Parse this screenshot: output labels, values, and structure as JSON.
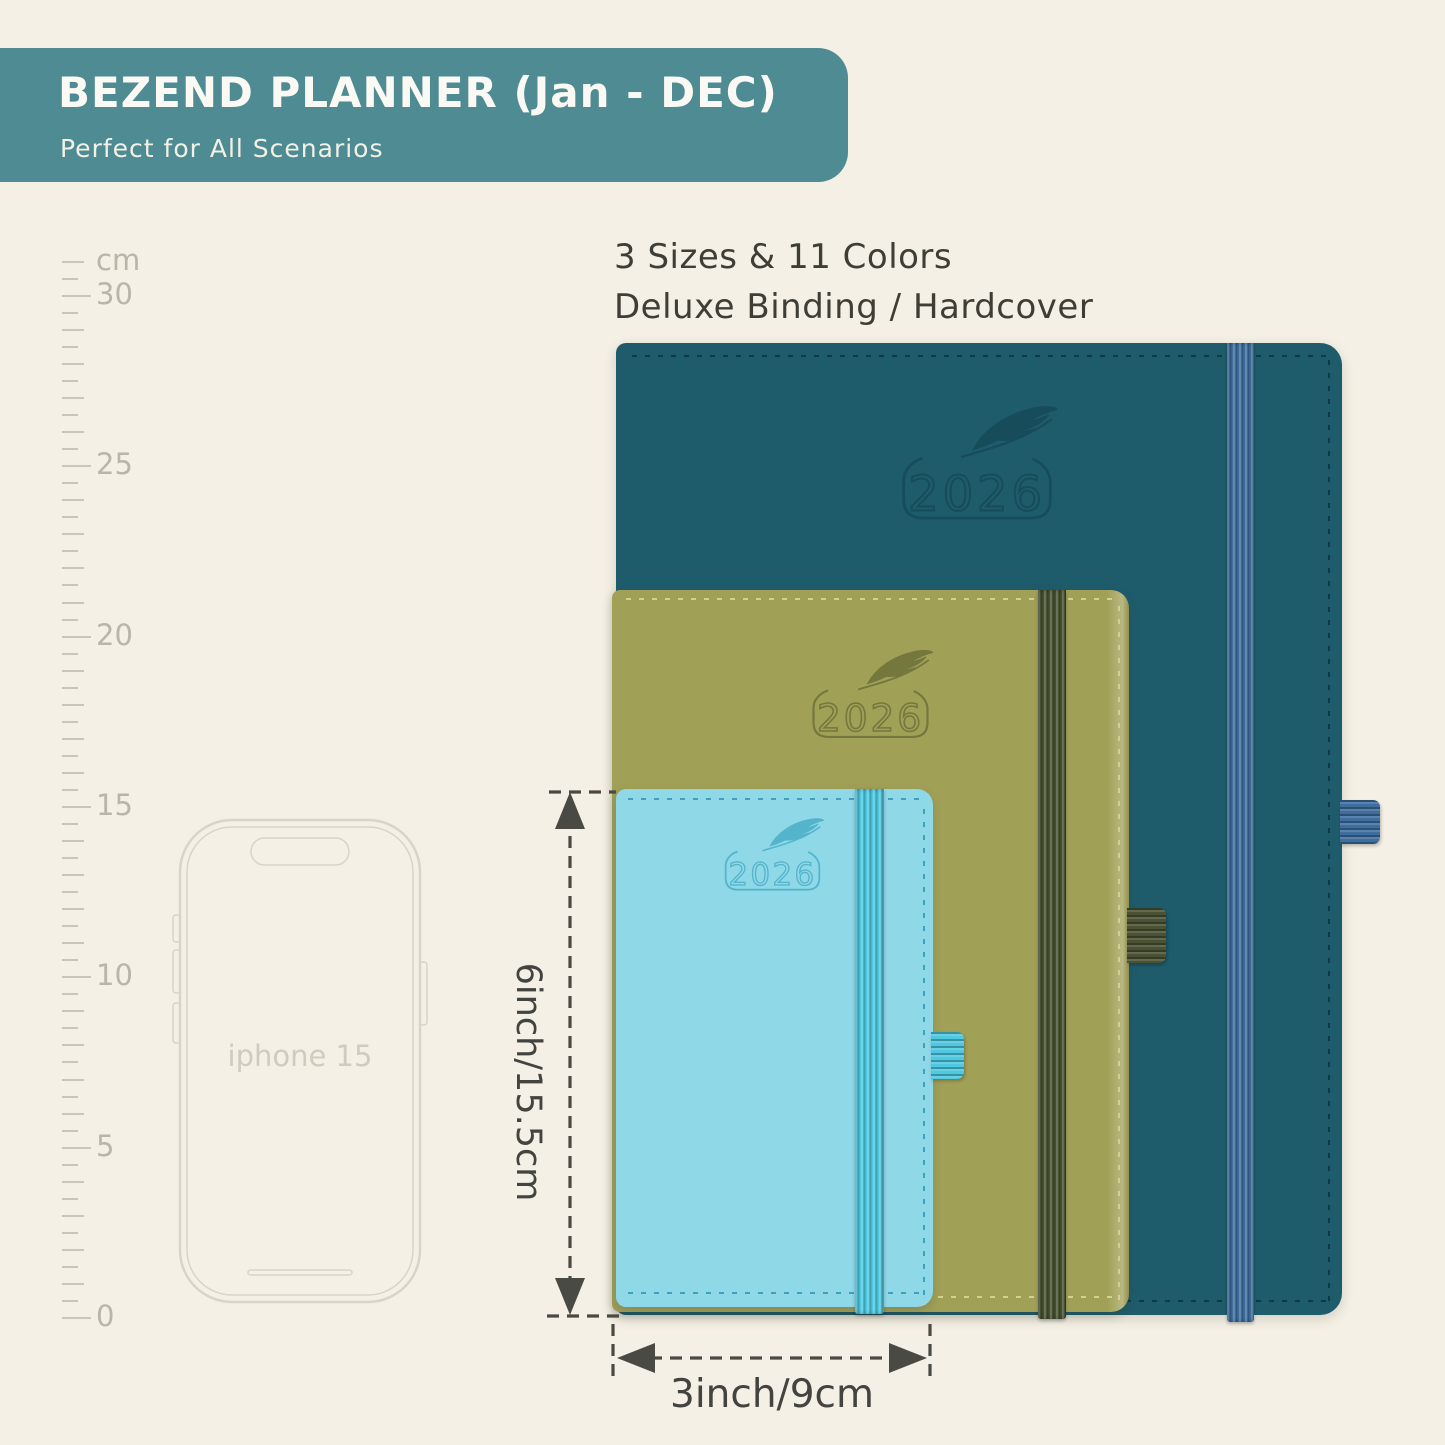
{
  "banner": {
    "title": "BEZEND PLANNER (Jan - DEC)",
    "subtitle": "Perfect for All Scenarios",
    "bg_color": "#4E8B93"
  },
  "highlights": {
    "line1": "3 Sizes & 11 Colors",
    "line2": "Deluxe Binding / Hardcover"
  },
  "ruler": {
    "unit_label": "cm",
    "max_cm": 31,
    "major_labels": [
      "30",
      "25",
      "20",
      "15",
      "10",
      "5",
      "0"
    ]
  },
  "phone": {
    "label": "iphone 15"
  },
  "planners": [
    {
      "size": "large",
      "year": "2026",
      "cover_color": "#1E5C6C",
      "band_color": "#3E6E9E",
      "loop_color": "#3E6E9E",
      "stitch_color": "#0F3944",
      "logo_color": "#174C5B"
    },
    {
      "size": "medium",
      "year": "2026",
      "cover_color": "#A1A057",
      "band_color": "#46502F",
      "loop_color": "#4A5233",
      "stitch_color": "#D6D08C",
      "logo_color": "#74783C"
    },
    {
      "size": "small",
      "year": "2026",
      "cover_color": "#8FD8E8",
      "band_color": "#4FC9E1",
      "loop_color": "#4FC9E1",
      "stitch_color": "#3FA0BC",
      "logo_color": "#54B4CB"
    }
  ],
  "dimensions": {
    "height_label": "6inch/15.5cm",
    "width_label": "3inch/9cm",
    "line_color": "#4A4A45"
  }
}
